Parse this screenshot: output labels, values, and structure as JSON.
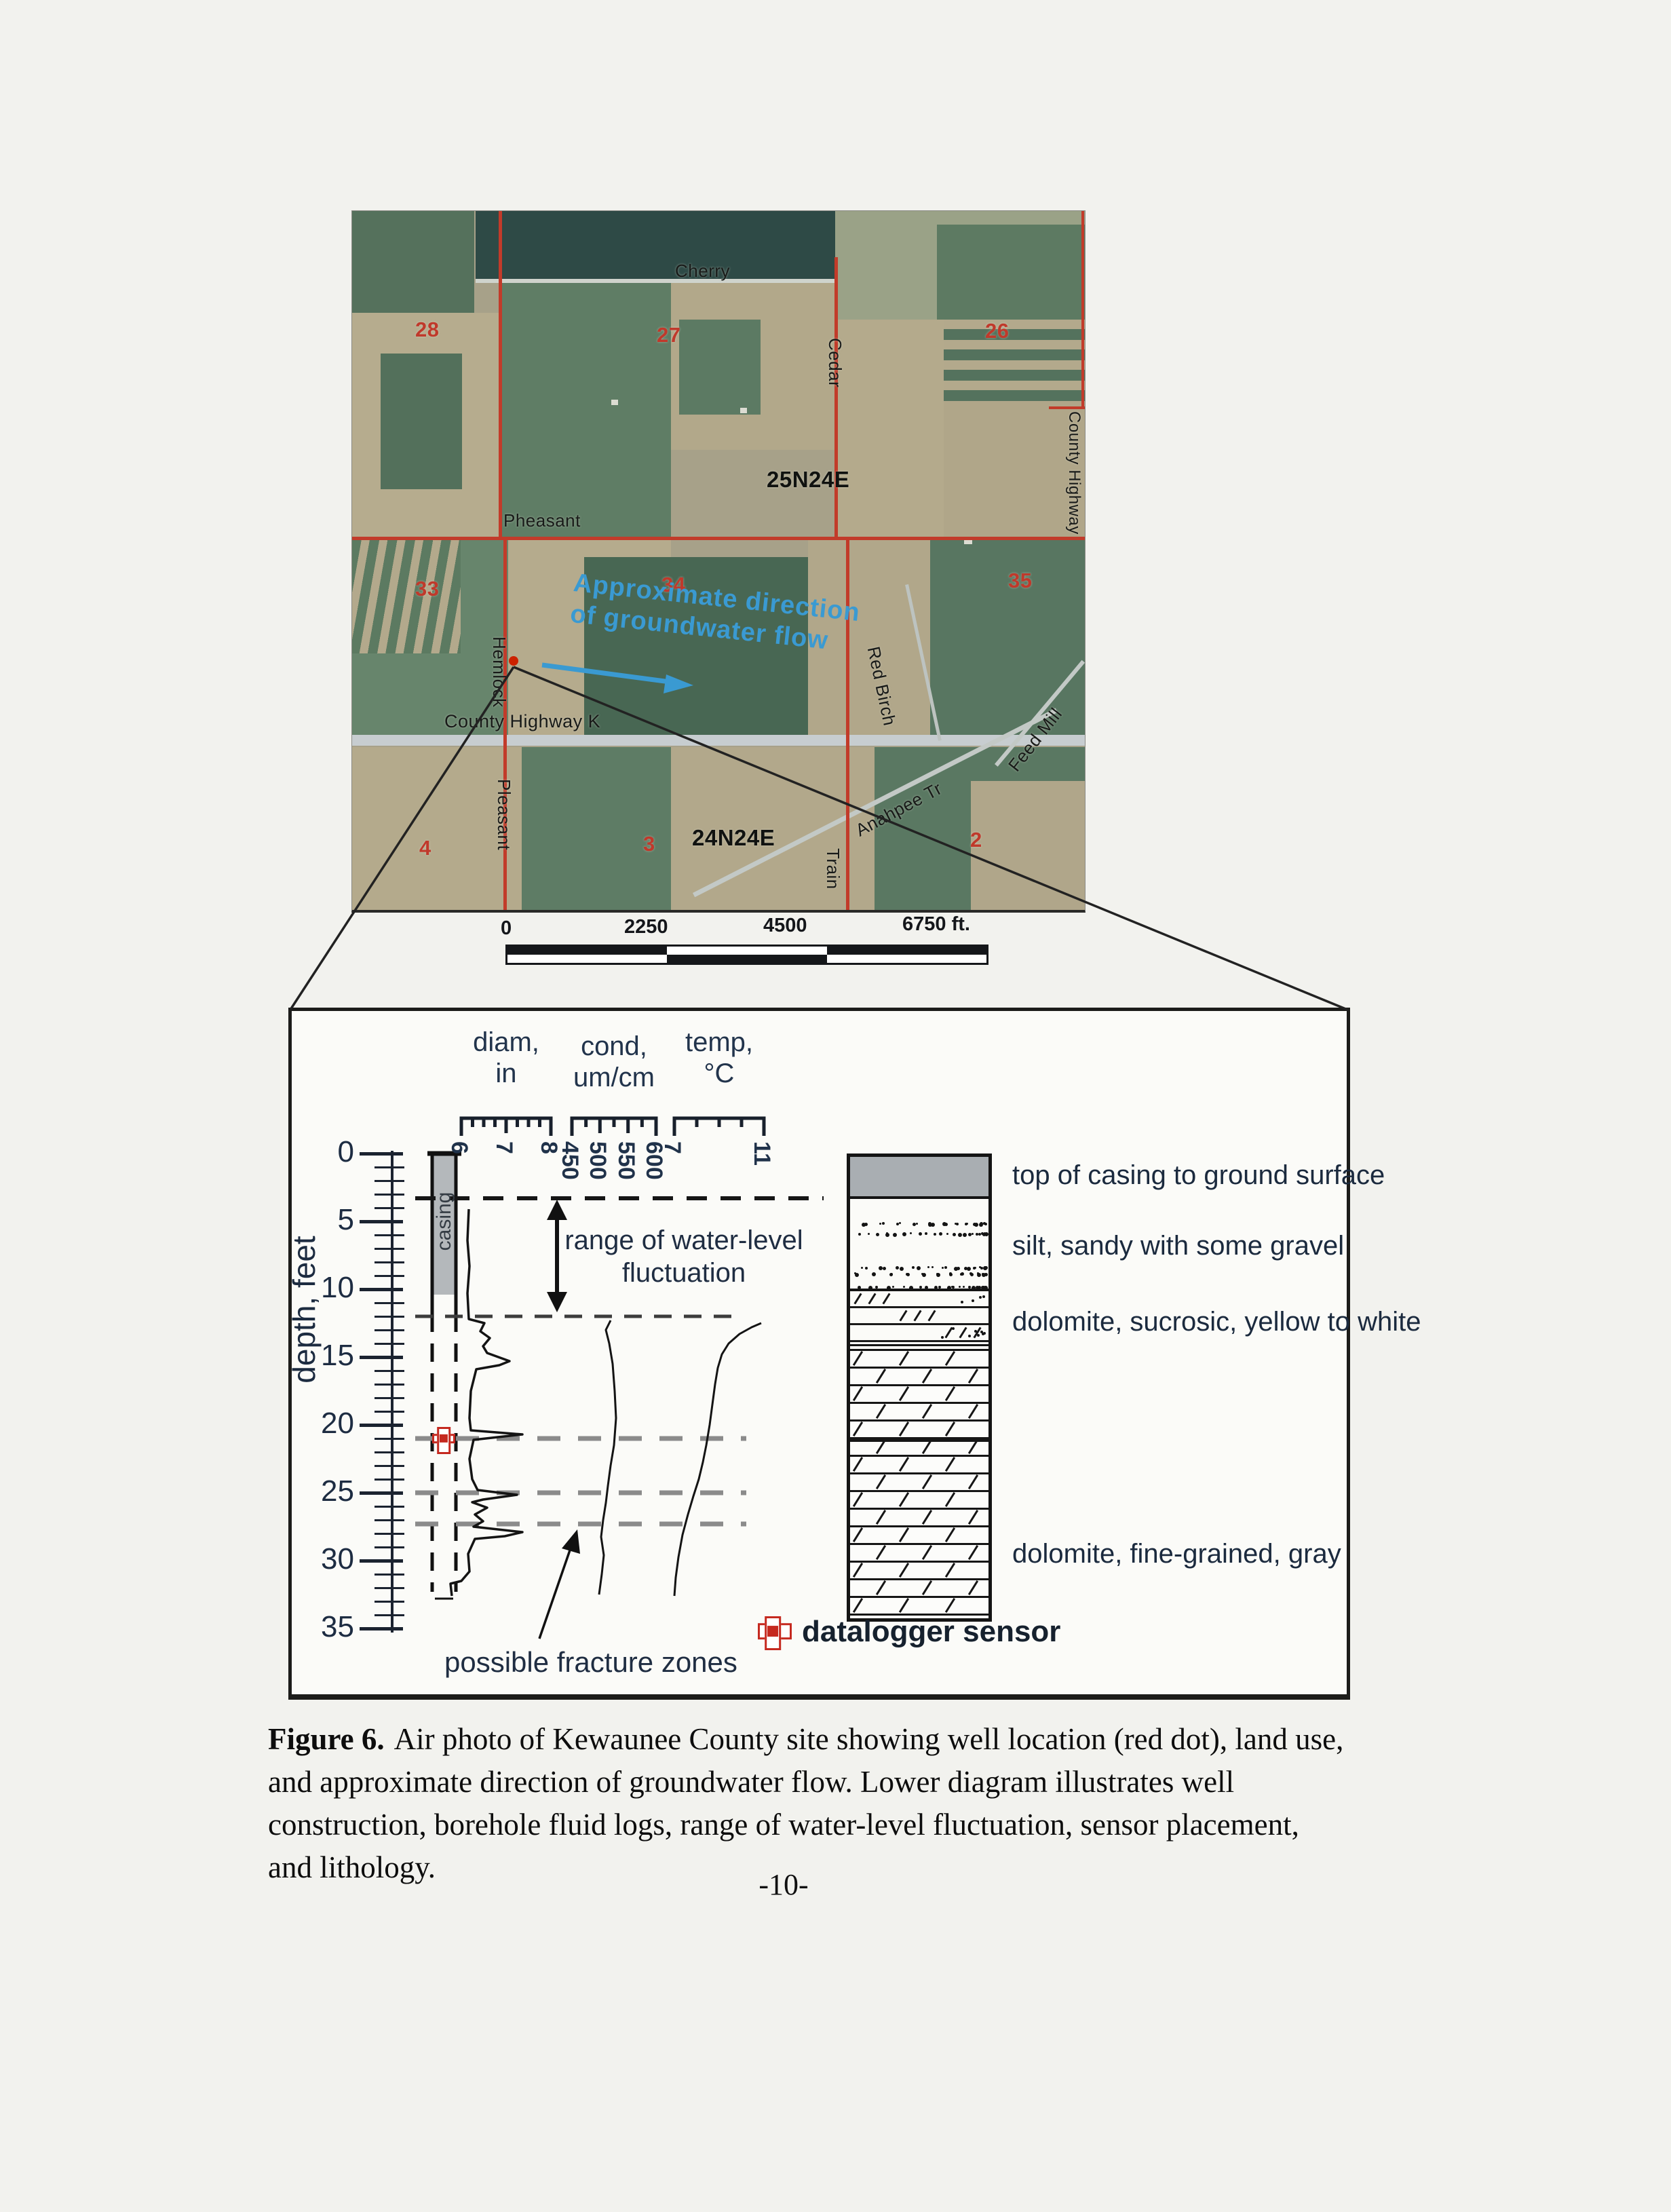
{
  "page": {
    "number": "-10-"
  },
  "caption": {
    "label": "Figure 6.",
    "line1_rest": "Air photo of Kewaunee County site showing well location (red dot), land use,",
    "line2": "and approximate direction of groundwater flow. Lower diagram illustrates well",
    "line3": "construction, borehole fluid logs, range of water-level fluctuation, sensor placement,",
    "line4": "and lithology."
  },
  "map": {
    "roads": {
      "cherry": "Cherry",
      "cedar": "Cedar",
      "pheasant": "Pheasant",
      "hemlock": "Hemlock",
      "county_hwy_k": "County Highway K",
      "pleasant": "Pleasant",
      "train": "Train",
      "red_birch": "Red Birch",
      "anahpee": "Anahpee Tr",
      "feed_mill": "Feed Mill",
      "county_hwy_right": "County Highway"
    },
    "townships": {
      "north": "25N24E",
      "south": "24N24E"
    },
    "sections": [
      "28",
      "27",
      "26",
      "33",
      "34",
      "35",
      "4",
      "3",
      "2"
    ],
    "flow_annotation": {
      "line1": "Approximate direction",
      "line2": "of groundwater flow"
    },
    "scale_bar": {
      "labels": [
        "0",
        "2250",
        "4500",
        "6750 ft."
      ]
    },
    "well_marker_color": "#cc2200",
    "flow_color": "#3a9ad2",
    "road_color": "#c23b2a"
  },
  "well_diagram": {
    "depth_axis": {
      "label": "depth, feet",
      "tick_labels": [
        "0",
        "5",
        "10",
        "15",
        "20",
        "25",
        "30",
        "35"
      ]
    },
    "logs": [
      {
        "name": "diam",
        "line1": "diam,",
        "line2": "in",
        "ticks": [
          "6",
          "7",
          "8"
        ]
      },
      {
        "name": "cond",
        "line1": "cond,",
        "line2": "um/cm",
        "ticks": [
          "450",
          "500",
          "550",
          "600"
        ]
      },
      {
        "name": "temp",
        "line1": "temp,",
        "line2": "°C",
        "ticks": [
          "7",
          "11"
        ]
      }
    ],
    "casing_label": "casing",
    "range_annotation": {
      "line1": "range of water-level",
      "line2": "fluctuation"
    },
    "fracture_annotation": "possible fracture zones",
    "legend": {
      "sensor_label": "datalogger sensor",
      "sensor_color": "#c5291f"
    },
    "water_level_range_ft": [
      3.3,
      12
    ],
    "fracture_zone_depths_ft": [
      21,
      25,
      27.3
    ],
    "sensor_depth_ft": 21,
    "lithology": [
      {
        "label": "top of casing to ground surface",
        "top_ft": 0,
        "bottom_ft": 3.3,
        "pattern": "solid-gray"
      },
      {
        "label": "silt, sandy with some gravel",
        "top_ft": 3.3,
        "bottom_ft": 10.3,
        "pattern": "stipple"
      },
      {
        "label": "dolomite, sucrosic, yellow to white",
        "top_ft": 10.3,
        "bottom_ft": 14.4,
        "pattern": "brick-dotted"
      },
      {
        "label": "dolomite, fine-grained, gray",
        "top_ft": 14.4,
        "bottom_ft": 34.5,
        "pattern": "brick"
      }
    ]
  }
}
